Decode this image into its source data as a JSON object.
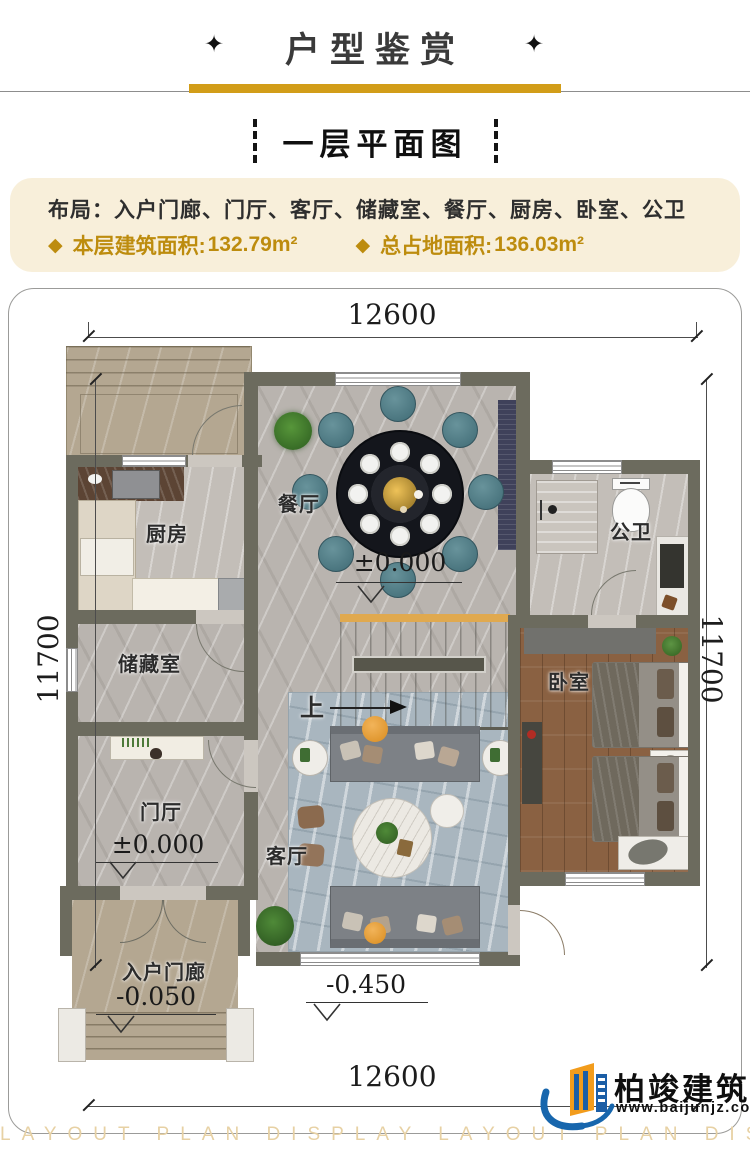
{
  "header": {
    "title": "户型鉴赏",
    "ornament": "✦"
  },
  "section": {
    "title": "一层平面图"
  },
  "info": {
    "layout_label": "布局：",
    "layout_rooms": "入户门廊、门厅、客厅、储藏室、餐厅、厨房、卧室、公卫",
    "bullet": "◆",
    "floor_area_label": "本层建筑面积:",
    "floor_area_value": "132.79m²",
    "total_area_label": "总占地面积:",
    "total_area_value": "136.03m²"
  },
  "plan": {
    "dim_width": "12600",
    "dim_height": "11700",
    "rooms": {
      "dining": "餐厅",
      "kitchen": "厨房",
      "bath": "公卫",
      "storage": "储藏室",
      "bedroom": "卧室",
      "foyer": "门厅",
      "living": "客厅",
      "porch": "入户门廊"
    },
    "stairs_up": "上",
    "elev_zero": "±0.000",
    "elev_porch": "-0.050",
    "elev_ground": "-0.450"
  },
  "logo": {
    "name": "柏竣建筑",
    "url": "www.baijunjz.com"
  },
  "watermark": {
    "text": "LAYOUT PLAN DISPLAY LAYOUT PLAN DISPLAY"
  }
}
